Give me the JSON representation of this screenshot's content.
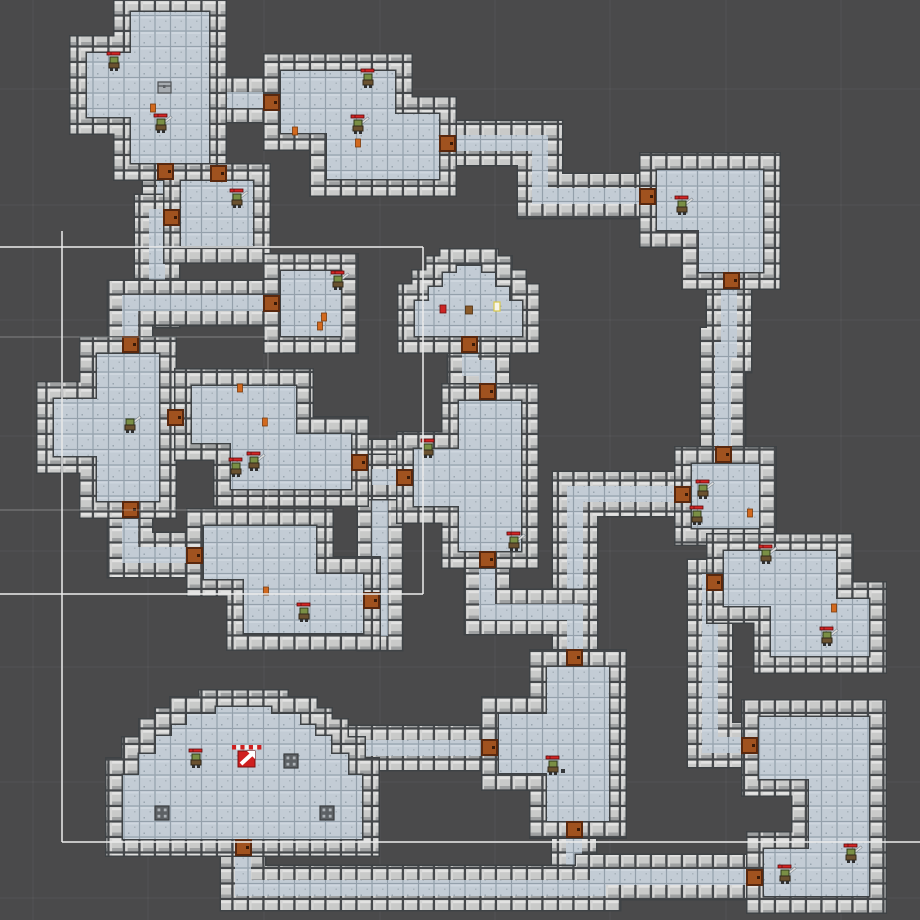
{
  "scene": {
    "width": 920,
    "height": 920,
    "background": "#4a4a4b",
    "description": "dungeon-tilemap-scene"
  },
  "palette": {
    "floor": "#b9c3cd",
    "floor_face": "#c3ccd5",
    "floor_line": "#94a0ab",
    "wall": "#c9cac9",
    "wall_hi": "#e2e2e1",
    "wall_sh": "#9fa1a2",
    "wall_gap": "#45484b",
    "outline": "#3e4245",
    "door": "#a0521f",
    "door_dark": "#59280e",
    "hp_red": "#d42525",
    "hp_border": "#5a0c0c",
    "gizmo_bright": "#ececec",
    "gizmo_faint": "rgba(215,215,215,0.40)",
    "grid_line": "rgba(255,255,255,0.05)",
    "monster_head": "#7a8f45",
    "monster_body": "#6b5230",
    "sword": "#dcdcdc",
    "flag_red": "#cf1f1f",
    "pillar": "#5d6165",
    "pillar_dot": "#aeb3b8"
  },
  "grid": {
    "vertical_x": [
      33,
      148,
      264,
      380,
      495,
      610,
      726,
      841
    ],
    "horizontal_y": [
      89,
      205,
      320,
      436,
      551,
      667,
      782,
      898
    ]
  },
  "rooms": [
    {
      "id": "room-top-left",
      "points": "122,3 218,3 218,172 122,172 122,126 78,126 78,44 122,44"
    },
    {
      "id": "room-small-north",
      "points": "172,172 262,172 262,255 172,255"
    },
    {
      "id": "room-top-middle",
      "points": "272,62 404,62 404,105 448,105 448,188 318,188 318,142 272,142"
    },
    {
      "id": "room-top-right",
      "points": "648,161 772,161 772,281 690,281 690,239 648,239"
    },
    {
      "id": "room-small-mid",
      "points": "272,262 350,262 350,345 272,345"
    },
    {
      "id": "room-dome-small",
      "points": "406,345 406,292 420,292 420,278 434,278 434,264 448,264 448,257 490,257 490,264 504,264 504,278 518,278 518,292 531,292 531,345"
    },
    {
      "id": "room-left-cross",
      "points": "88,345 168,345 168,510 88,510 88,465 45,465 45,390 88,390"
    },
    {
      "id": "room-mid-large",
      "points": "183,377 305,377 305,425 360,425 360,498 222,498 222,452 183,452"
    },
    {
      "id": "room-center-tall",
      "points": "450,392 530,392 530,560 450,560 450,515 405,515 405,440 450,440"
    },
    {
      "id": "room-right-small",
      "points": "683,455 768,455 768,537 683,537"
    },
    {
      "id": "room-lower-middle",
      "points": "195,517 325,517 325,565 372,565 372,642 235,642 235,588 195,588"
    },
    {
      "id": "room-right-east",
      "points": "715,542 845,542 845,590 878,590 878,665 762,665 762,615 715,615"
    },
    {
      "id": "room-bottom-middle",
      "points": "538,658 618,658 618,830 538,830 538,782 490,782 490,705 538,705"
    },
    {
      "id": "room-dome-large",
      "points": "114,848 114,766 130,766 130,745 147,745 147,727 163,727 163,716 178,716 178,705 207,705 207,698 280,698 280,705 309,705 309,716 324,716 324,727 340,727 340,745 357,745 357,766 371,766 371,848"
    },
    {
      "id": "room-bottom-right",
      "points": "750,708 878,708 878,905 755,905 755,840 800,840 800,788 750,788"
    }
  ],
  "corridors": [
    {
      "id": "cor-tl-tm",
      "d": "M208,100 L280,100"
    },
    {
      "id": "cor-tm-tr",
      "d": "M440,143 L540,143 L540,196 L658,196"
    },
    {
      "id": "cor-tr-rs",
      "d": "M729,272 L729,350 L723,350 L723,462"
    },
    {
      "id": "cor-rs-west",
      "d": "M690,494 L575,494 L575,616"
    },
    {
      "id": "cor-center-south",
      "d": "M487,550 L487,612 L575,612 L575,668"
    },
    {
      "id": "cor-tl-down",
      "d": "M165,164 L165,222"
    },
    {
      "id": "cor-smallN-west",
      "d": "M186,217 L157,217 L157,305"
    },
    {
      "id": "cor-west-branch",
      "d": "M130,352 L130,303 L278,303"
    },
    {
      "id": "cor-cross-down",
      "d": "M130,500 L130,555 L200,555"
    },
    {
      "id": "cor-mid-east",
      "d": "M352,462 L380,462 L380,628"
    },
    {
      "id": "cor-mid-east2",
      "d": "M380,477 L412,477"
    },
    {
      "id": "cor-dome-center",
      "d": "M470,336 L470,368 L487,368 L487,404"
    },
    {
      "id": "cor-domeL-east",
      "d": "M356,748 L496,748"
    },
    {
      "id": "cor-bm-down",
      "d": "M574,820 L574,888"
    },
    {
      "id": "cor-south-long",
      "d": "M243,838 L243,888 L598,888 L598,877 L760,877"
    },
    {
      "id": "cor-east-down",
      "d": "M722,582 L710,582 L710,745 L756,745"
    }
  ],
  "doors": [
    {
      "x": 158,
      "y": 164
    },
    {
      "x": 211,
      "y": 166
    },
    {
      "x": 164,
      "y": 210
    },
    {
      "x": 264,
      "y": 95
    },
    {
      "x": 440,
      "y": 136
    },
    {
      "x": 640,
      "y": 189
    },
    {
      "x": 724,
      "y": 273
    },
    {
      "x": 716,
      "y": 447
    },
    {
      "x": 675,
      "y": 487
    },
    {
      "x": 264,
      "y": 296
    },
    {
      "x": 462,
      "y": 337
    },
    {
      "x": 123,
      "y": 337
    },
    {
      "x": 123,
      "y": 502
    },
    {
      "x": 168,
      "y": 410
    },
    {
      "x": 352,
      "y": 455
    },
    {
      "x": 480,
      "y": 384
    },
    {
      "x": 397,
      "y": 470
    },
    {
      "x": 480,
      "y": 552
    },
    {
      "x": 187,
      "y": 548
    },
    {
      "x": 364,
      "y": 593
    },
    {
      "x": 567,
      "y": 650
    },
    {
      "x": 482,
      "y": 740
    },
    {
      "x": 567,
      "y": 822
    },
    {
      "x": 236,
      "y": 840
    },
    {
      "x": 742,
      "y": 738
    },
    {
      "x": 747,
      "y": 870
    },
    {
      "x": 707,
      "y": 575
    }
  ],
  "entities": [
    {
      "type": "monster",
      "x": 114,
      "y": 64,
      "hp": true,
      "sword": false
    },
    {
      "type": "chest",
      "x": 164,
      "y": 87
    },
    {
      "type": "item-orange",
      "x": 153,
      "y": 108
    },
    {
      "type": "monster",
      "x": 161,
      "y": 126,
      "hp": true,
      "sword": true
    },
    {
      "type": "monster",
      "x": 368,
      "y": 81,
      "hp": true,
      "sword": false
    },
    {
      "type": "monster",
      "x": 358,
      "y": 127,
      "hp": true,
      "sword": true
    },
    {
      "type": "item-orange",
      "x": 295,
      "y": 131
    },
    {
      "type": "item-orange",
      "x": 358,
      "y": 143
    },
    {
      "type": "monster",
      "x": 237,
      "y": 201,
      "hp": true,
      "sword": true
    },
    {
      "type": "monster",
      "x": 338,
      "y": 283,
      "hp": true,
      "sword": true
    },
    {
      "type": "item-orange",
      "x": 324,
      "y": 317
    },
    {
      "type": "item-orange",
      "x": 320,
      "y": 326
    },
    {
      "type": "item-red",
      "x": 443,
      "y": 309
    },
    {
      "type": "item-brown",
      "x": 469,
      "y": 310
    },
    {
      "type": "item-white",
      "x": 497,
      "y": 307
    },
    {
      "type": "monster",
      "x": 682,
      "y": 208,
      "hp": true,
      "sword": true
    },
    {
      "type": "monster",
      "x": 130,
      "y": 426,
      "hp": false,
      "sword": true
    },
    {
      "type": "item-orange",
      "x": 240,
      "y": 388
    },
    {
      "type": "item-orange",
      "x": 265,
      "y": 422
    },
    {
      "type": "monster",
      "x": 236,
      "y": 470,
      "hp": true,
      "sword": false
    },
    {
      "type": "monster",
      "x": 254,
      "y": 464,
      "hp": true,
      "sword": true
    },
    {
      "type": "monster",
      "x": 428,
      "y": 451,
      "hp": true,
      "sword": false
    },
    {
      "type": "monster",
      "x": 514,
      "y": 544,
      "hp": true,
      "sword": true
    },
    {
      "type": "monster",
      "x": 703,
      "y": 492,
      "hp": true,
      "sword": true
    },
    {
      "type": "monster",
      "x": 697,
      "y": 518,
      "hp": true,
      "sword": false
    },
    {
      "type": "item-orange",
      "x": 750,
      "y": 513
    },
    {
      "type": "monster",
      "x": 766,
      "y": 557,
      "hp": true,
      "sword": true
    },
    {
      "type": "monster",
      "x": 827,
      "y": 639,
      "hp": true,
      "sword": true
    },
    {
      "type": "item-orange",
      "x": 834,
      "y": 608
    },
    {
      "type": "monster",
      "x": 304,
      "y": 615,
      "hp": true,
      "sword": false
    },
    {
      "type": "item-orange",
      "x": 266,
      "y": 591
    },
    {
      "type": "monster",
      "x": 553,
      "y": 768,
      "hp": true,
      "sword": false
    },
    {
      "type": "item-dark",
      "x": 563,
      "y": 771
    },
    {
      "type": "monster",
      "x": 196,
      "y": 761,
      "hp": true,
      "sword": false
    },
    {
      "type": "flag",
      "x": 247,
      "y": 758
    },
    {
      "type": "pillar",
      "x": 162,
      "y": 813
    },
    {
      "type": "pillar",
      "x": 291,
      "y": 761
    },
    {
      "type": "pillar",
      "x": 327,
      "y": 813
    },
    {
      "type": "monster",
      "x": 785,
      "y": 877,
      "hp": true,
      "sword": true
    },
    {
      "type": "monster",
      "x": 851,
      "y": 856,
      "hp": true,
      "sword": true
    }
  ],
  "gizmo_lines": {
    "bright": [
      {
        "x1": 0,
        "y1": 247,
        "x2": 423,
        "y2": 247
      },
      {
        "x1": 423,
        "y1": 247,
        "x2": 423,
        "y2": 594
      },
      {
        "x1": 0,
        "y1": 594,
        "x2": 423,
        "y2": 594
      },
      {
        "x1": 62,
        "y1": 231,
        "x2": 62,
        "y2": 842
      },
      {
        "x1": 62,
        "y1": 842,
        "x2": 920,
        "y2": 842
      }
    ],
    "faint": [
      {
        "x1": 0,
        "y1": 337,
        "x2": 268,
        "y2": 337
      },
      {
        "x1": 268,
        "y1": 337,
        "x2": 268,
        "y2": 510
      },
      {
        "x1": 0,
        "y1": 510,
        "x2": 268,
        "y2": 510
      }
    ]
  }
}
